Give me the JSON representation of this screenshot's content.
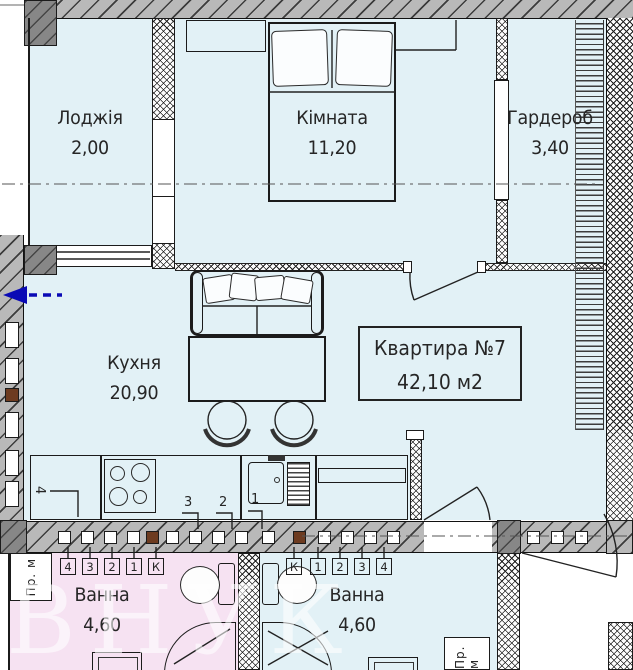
{
  "plan": {
    "apartment_box": {
      "title": "Квартира №7",
      "area": "42,10 м2"
    },
    "rooms": {
      "loggia": {
        "name": "Лоджія",
        "area": "2,00"
      },
      "bedroom": {
        "name": "Кімната",
        "area": "11,20"
      },
      "wardrobe": {
        "name": "Гардероб",
        "area": "3,40"
      },
      "kitchen": {
        "name": "Кухня",
        "area": "20,90"
      },
      "bath_left": {
        "name": "Ванна",
        "area": "4,60"
      },
      "bath_right": {
        "name": "Ванна",
        "area": "4,60"
      }
    },
    "riser_tags_left": [
      "4",
      "3",
      "2",
      "1",
      "К"
    ],
    "riser_tags_right": [
      "К",
      "1",
      "2",
      "3",
      "4"
    ],
    "counter_tags": [
      "4",
      "3",
      "2",
      "1"
    ],
    "utility_label_left": "Пр. м",
    "utility_label_right": "Пр. м",
    "watermark": "ВНУК",
    "colors": {
      "room_fill": "#e2f1f6",
      "neighbor_room_fill": "#f6e2f2",
      "wall_fill": "#b9b9b9",
      "concrete_fill": "#878787",
      "riser_brown": "#6d3b20",
      "entry_arrow_blue": "#0a0ab5"
    }
  }
}
